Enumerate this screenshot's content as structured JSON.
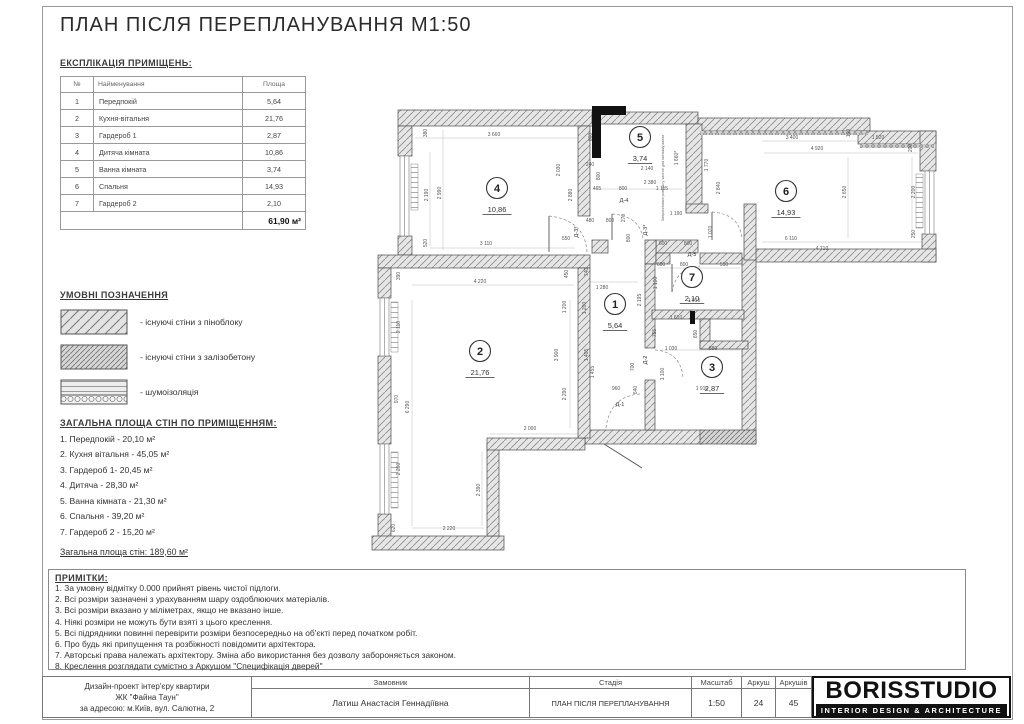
{
  "sheet": {
    "title": "ПЛАН ПІСЛЯ ПЕРЕПЛАНУВАННЯ М1:50"
  },
  "colors": {
    "wall_line": "#4a4a4a",
    "dim_text": "#555555",
    "logo_bg": "#111111"
  },
  "explication": {
    "heading": "ЕКСПЛІКАЦІЯ ПРИМІЩЕНЬ:",
    "columns": [
      "№",
      "Найменування",
      "Площа"
    ],
    "rows": [
      [
        "1",
        "Передпокій",
        "5,64"
      ],
      [
        "2",
        "Кухня-вітальня",
        "21,76"
      ],
      [
        "3",
        "Гардероб 1",
        "2,87"
      ],
      [
        "4",
        "Дитяча кімната",
        "10,86"
      ],
      [
        "5",
        "Ванна кімната",
        "3,74"
      ],
      [
        "6",
        "Спальня",
        "14,93"
      ],
      [
        "7",
        "Гардероб 2",
        "2,10"
      ]
    ],
    "total": "61,90 м²"
  },
  "legend": {
    "heading": "УМОВНІ ПОЗНАЧЕННЯ",
    "items": [
      {
        "label": "- існуючі стіни з піноблоку",
        "pattern": "pinoblock"
      },
      {
        "label": "- існуючі стіни з залізобетону",
        "pattern": "concrete"
      },
      {
        "label": "- шумоізоляція",
        "pattern": "soundproof"
      }
    ]
  },
  "wall_areas": {
    "heading": "ЗАГАЛЬНА ПЛОЩА СТІН ПО ПРИМІЩЕННЯМ:",
    "items": [
      "1. Передпокій - 20,10 м²",
      "2. Кухня вітальня - 45,05 м²",
      "3. Гардероб 1- 20,45 м²",
      "4. Дитяча - 28,30 м²",
      "5. Ванна кімната - 21,30 м²",
      "6. Спальня - 39,20 м²",
      "7. Гардероб 2 - 15,20 м²"
    ],
    "total": "Загальна площа стін: 189,60 м²"
  },
  "notes": {
    "heading": "ПРИМІТКИ:",
    "lines": [
      "1. За умовну відмітку 0.000 прийнят рівень чистої підлоги.",
      "2. Всі розміри зазначені з урахуванням шару оздоблюючих матеріалів.",
      "3. Всі розміри вказано у міліметрах, якщо не вказано інше.",
      "4. Ніякі розміри не можуть бути взяті з цього креслення.",
      "5. Всі підрядники повинні перевірити розміри безпосередньо на об'єкті перед початком робіт.",
      "6. Про будь які припущення та розбіжності повідомити архітектора.",
      "7. Авторські права належать архітектору. Зміна або використання без дозволу забороняється законом.",
      "8. Креслення розглядати сумістно з Аркушом \"Специфікація дверей\""
    ]
  },
  "titleblock": {
    "project_lines": [
      "Дизайн-проект інтер'єру квартири",
      "ЖК \"Файна Таун\"",
      "за адресою: м.Київ, вул. Салютна, 2"
    ],
    "client_label": "Замовник",
    "client_value": "Латиш Анастасія Геннадіївна",
    "stage_label": "Стадія",
    "stage_value": "ПЛАН ПІСЛЯ ПЕРЕПЛАНУВАННЯ",
    "scale_label": "Масштаб",
    "scale_value": "1:50",
    "sheet_label": "Аркуш",
    "sheet_value": "24",
    "sheets_label": "Аркушів",
    "sheets_value": "45",
    "logo_title": "BORISSTUDIO",
    "logo_subtitle": "INTERIOR DESIGN & ARCHITECTURE"
  },
  "plan": {
    "rooms": [
      {
        "n": "1",
        "a": "5,64",
        "x": 615,
        "y": 304
      },
      {
        "n": "2",
        "a": "21,76",
        "x": 480,
        "y": 351
      },
      {
        "n": "3",
        "a": "2,87",
        "x": 712,
        "y": 367
      },
      {
        "n": "4",
        "a": "10,86",
        "x": 497,
        "y": 188
      },
      {
        "n": "5",
        "a": "3,74",
        "x": 640,
        "y": 137
      },
      {
        "n": "6",
        "a": "14,93",
        "x": 786,
        "y": 191
      },
      {
        "n": "7",
        "a": "2,10",
        "x": 692,
        "y": 277
      }
    ],
    "doors": [
      {
        "t": "Д-4",
        "x": 624,
        "y": 202
      },
      {
        "t": "Д-3*",
        "x": 578,
        "y": 232,
        "r": 1
      },
      {
        "t": "Д-3*",
        "x": 647,
        "y": 230,
        "r": 1
      },
      {
        "t": "Д-5",
        "x": 692,
        "y": 256
      },
      {
        "t": "Д-2",
        "x": 647,
        "y": 360,
        "r": 1
      },
      {
        "t": "Д-1",
        "x": 620,
        "y": 406
      }
    ],
    "annotation": {
      "t": "Запроектовані розміри у чистоті для монтажу ванни",
      "x": 664,
      "y": 178,
      "r": 1
    },
    "dims": [
      {
        "t": "3 660",
        "x": 494,
        "y": 136
      },
      {
        "t": "380",
        "x": 427,
        "y": 133,
        "r": 1
      },
      {
        "t": "2 190",
        "x": 428,
        "y": 195,
        "r": 1
      },
      {
        "t": "2 990",
        "x": 441,
        "y": 193,
        "r": 1
      },
      {
        "t": "520",
        "x": 427,
        "y": 243,
        "r": 1
      },
      {
        "t": "3 110",
        "x": 486,
        "y": 245
      },
      {
        "t": "860",
        "x": 592,
        "y": 137,
        "r": 1
      },
      {
        "t": "2 030",
        "x": 560,
        "y": 170,
        "r": 1
      },
      {
        "t": "2 880",
        "x": 572,
        "y": 195,
        "r": 1
      },
      {
        "t": "240",
        "x": 590,
        "y": 166
      },
      {
        "t": "800",
        "x": 600,
        "y": 176,
        "r": 1
      },
      {
        "t": "465",
        "x": 597,
        "y": 190
      },
      {
        "t": "800",
        "x": 623,
        "y": 190
      },
      {
        "t": "1 115",
        "x": 662,
        "y": 190
      },
      {
        "t": "2 140",
        "x": 647,
        "y": 170
      },
      {
        "t": "2 380",
        "x": 650,
        "y": 184
      },
      {
        "t": "1 660*",
        "x": 678,
        "y": 158,
        "r": 1
      },
      {
        "t": "480",
        "x": 590,
        "y": 222
      },
      {
        "t": "800",
        "x": 610,
        "y": 222
      },
      {
        "t": "270",
        "x": 625,
        "y": 218,
        "r": 1
      },
      {
        "t": "550",
        "x": 566,
        "y": 240
      },
      {
        "t": "800",
        "x": 630,
        "y": 238,
        "r": 1
      },
      {
        "t": "1 190",
        "x": 676,
        "y": 215
      },
      {
        "t": "1 070",
        "x": 712,
        "y": 232,
        "r": 1
      },
      {
        "t": "1 770",
        "x": 708,
        "y": 165,
        "r": 1
      },
      {
        "t": "2 840",
        "x": 720,
        "y": 188,
        "r": 1
      },
      {
        "t": "3 400",
        "x": 792,
        "y": 139
      },
      {
        "t": "4 920",
        "x": 817,
        "y": 150
      },
      {
        "t": "190",
        "x": 850,
        "y": 133,
        "r": 1
      },
      {
        "t": "1 520",
        "x": 878,
        "y": 139
      },
      {
        "t": "200",
        "x": 912,
        "y": 148,
        "r": 1
      },
      {
        "t": "2 650",
        "x": 846,
        "y": 192,
        "r": 1
      },
      {
        "t": "2 200",
        "x": 915,
        "y": 192,
        "r": 1
      },
      {
        "t": "250",
        "x": 915,
        "y": 234,
        "r": 1
      },
      {
        "t": "6 110",
        "x": 791,
        "y": 240
      },
      {
        "t": "4 710",
        "x": 822,
        "y": 250
      },
      {
        "t": "600",
        "x": 663,
        "y": 245
      },
      {
        "t": "800",
        "x": 688,
        "y": 245
      },
      {
        "t": "600",
        "x": 661,
        "y": 266
      },
      {
        "t": "800",
        "x": 684,
        "y": 266
      },
      {
        "t": "510",
        "x": 724,
        "y": 266
      },
      {
        "t": "1 100",
        "x": 657,
        "y": 283,
        "r": 1
      },
      {
        "t": "1 910",
        "x": 694,
        "y": 302
      },
      {
        "t": "1 280",
        "x": 602,
        "y": 289
      },
      {
        "t": "740",
        "x": 588,
        "y": 272,
        "r": 1
      },
      {
        "t": "2 195",
        "x": 641,
        "y": 300,
        "r": 1
      },
      {
        "t": "1 200",
        "x": 586,
        "y": 308,
        "r": 1
      },
      {
        "t": "1 610",
        "x": 676,
        "y": 319
      },
      {
        "t": "755",
        "x": 656,
        "y": 333,
        "r": 1
      },
      {
        "t": "650",
        "x": 697,
        "y": 334,
        "r": 1
      },
      {
        "t": "1 030",
        "x": 671,
        "y": 350
      },
      {
        "t": "880",
        "x": 713,
        "y": 350
      },
      {
        "t": "700",
        "x": 634,
        "y": 367,
        "r": 1
      },
      {
        "t": "1 405",
        "x": 588,
        "y": 355,
        "r": 1
      },
      {
        "t": "1 100",
        "x": 664,
        "y": 374,
        "r": 1
      },
      {
        "t": "1 910",
        "x": 702,
        "y": 390
      },
      {
        "t": "960",
        "x": 616,
        "y": 390
      },
      {
        "t": "640",
        "x": 637,
        "y": 390,
        "r": 1
      },
      {
        "t": "390",
        "x": 400,
        "y": 276,
        "r": 1
      },
      {
        "t": "4 220",
        "x": 480,
        "y": 283
      },
      {
        "t": "450",
        "x": 568,
        "y": 274,
        "r": 1
      },
      {
        "t": "2 110",
        "x": 400,
        "y": 327,
        "r": 1
      },
      {
        "t": "1 200",
        "x": 566,
        "y": 307,
        "r": 1
      },
      {
        "t": "3 900",
        "x": 558,
        "y": 355,
        "r": 1
      },
      {
        "t": "6 290",
        "x": 409,
        "y": 407,
        "r": 1
      },
      {
        "t": "970",
        "x": 398,
        "y": 399,
        "r": 1
      },
      {
        "t": "2 290",
        "x": 566,
        "y": 394,
        "r": 1
      },
      {
        "t": "1 455",
        "x": 594,
        "y": 372,
        "r": 1
      },
      {
        "t": "2 000",
        "x": 530,
        "y": 430
      },
      {
        "t": "2 390",
        "x": 480,
        "y": 490,
        "r": 1
      },
      {
        "t": "2 200",
        "x": 400,
        "y": 469,
        "r": 1
      },
      {
        "t": "620",
        "x": 395,
        "y": 528,
        "r": 1
      },
      {
        "t": "2 220",
        "x": 449,
        "y": 530
      }
    ]
  }
}
